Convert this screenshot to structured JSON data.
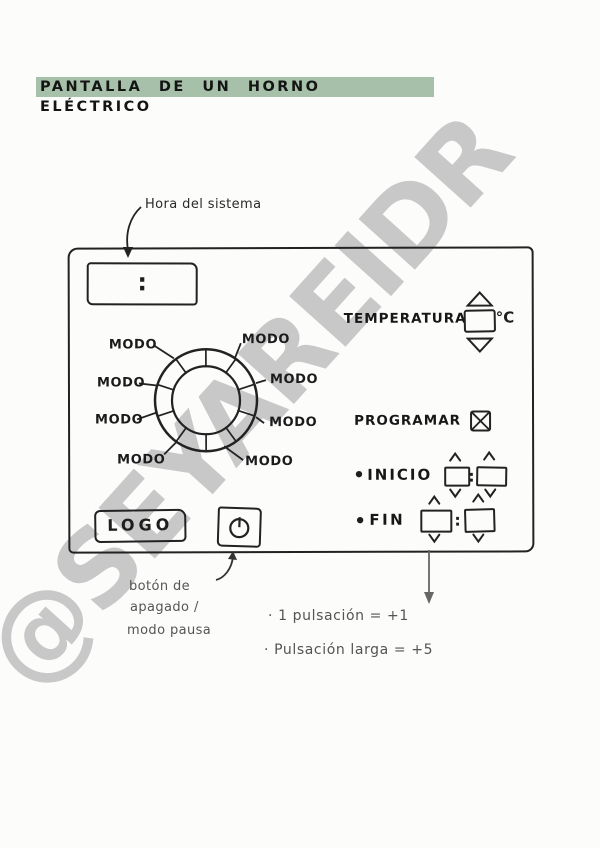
{
  "title": "PANTALLA DE UN HORNO ELÉCTRICO",
  "watermark": "@SEYAREIDR",
  "colors": {
    "title_highlight": "#a6c0aa",
    "ink": "#222222",
    "watermark_gray": "#c8c8c8",
    "pencil_gray": "#555555"
  },
  "annotations": {
    "clock_label": "Hora del sistema",
    "power_label_line1": "botón de",
    "power_label_line2": "apagado /",
    "power_label_line3": "modo pausa",
    "pulse_note_1": "· 1 pulsación = +1",
    "pulse_note_2": "· Pulsación larga = +5"
  },
  "panel": {
    "clock": {
      "value": ":"
    },
    "dial": {
      "modes": [
        "MODO",
        "MODO",
        "MODO",
        "MODO",
        "MODO",
        "MODO",
        "MODO",
        "MODO"
      ]
    },
    "temperature": {
      "label": "TEMPERATURA",
      "value": "",
      "unit": "°C"
    },
    "program": {
      "label": "PROGRAMAR",
      "checked": true
    },
    "start": {
      "bullet": "•",
      "label": "INICIO",
      "separator": ":",
      "hour": "",
      "minute": ""
    },
    "end": {
      "bullet": "•",
      "label": "FIN",
      "separator": ":",
      "hour": "",
      "minute": ""
    },
    "logo": "LOGO"
  }
}
